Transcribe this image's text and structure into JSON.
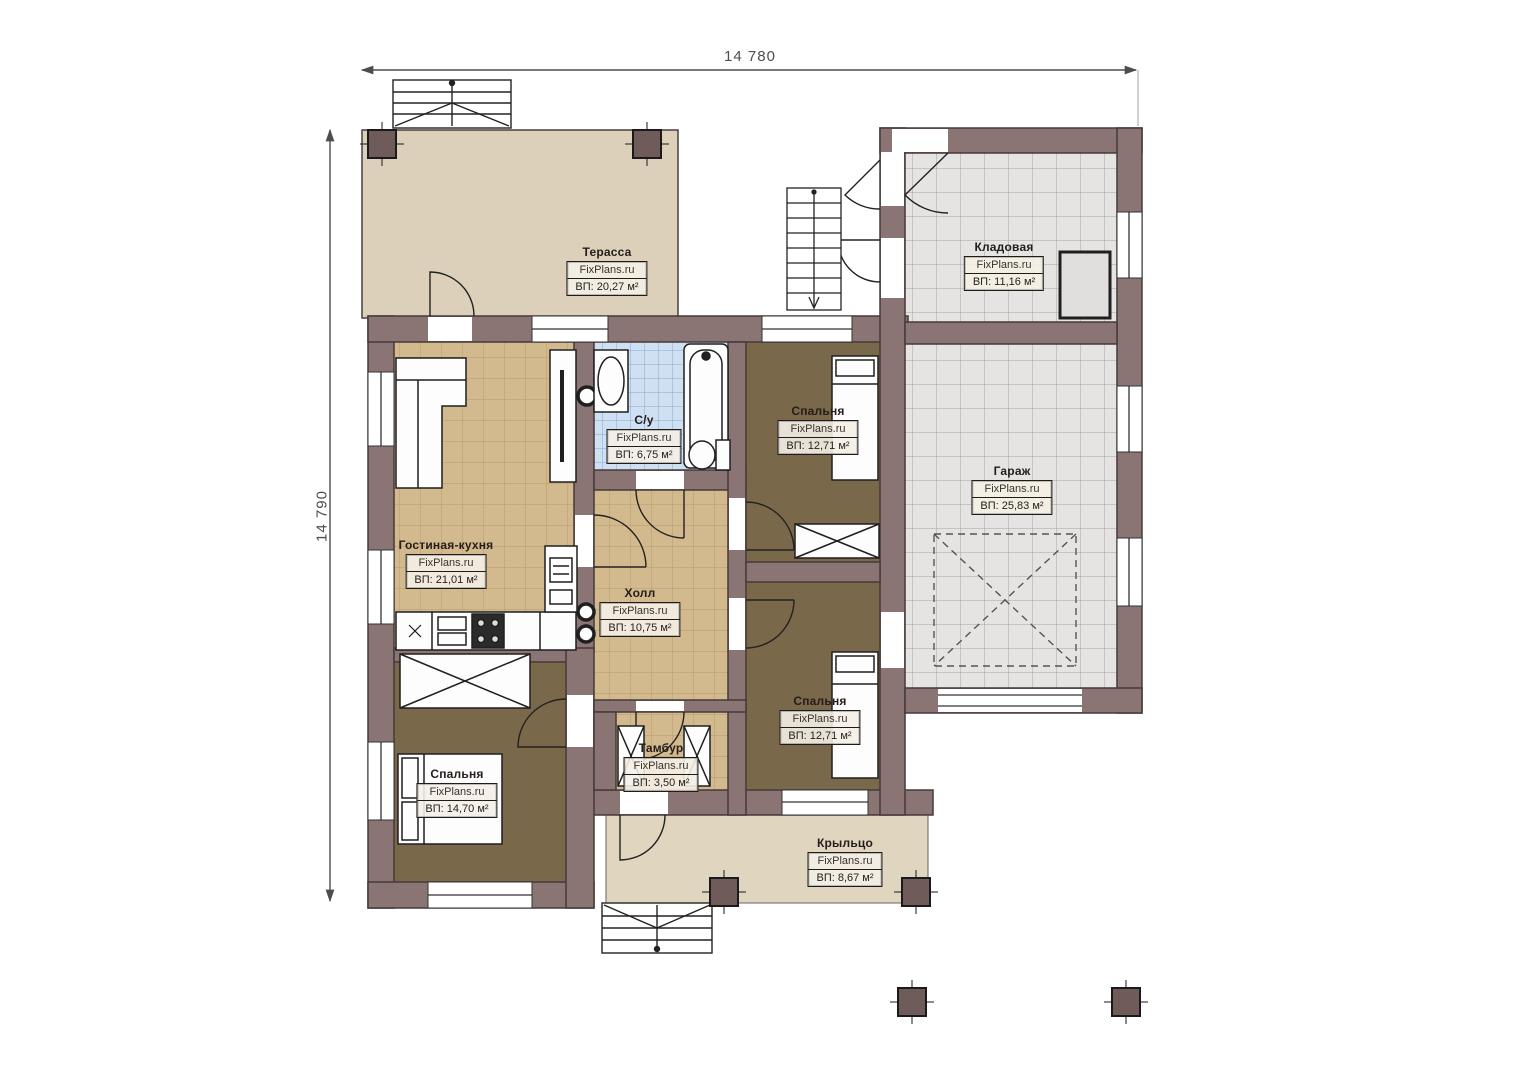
{
  "plan": {
    "dimensions": {
      "top": "14 780",
      "left": "14 790"
    },
    "branding": {
      "watermark": "FixPlans.ru"
    },
    "rooms": [
      {
        "id": "terrace",
        "name": "Терасса",
        "area": "ВП: 20,27 м²"
      },
      {
        "id": "storage",
        "name": "Кладовая",
        "area": "ВП: 11,16 м²"
      },
      {
        "id": "bedroom-top-right",
        "name": "Спальня",
        "area": "ВП: 12,71 м²"
      },
      {
        "id": "garage",
        "name": "Гараж",
        "area": "ВП: 25,83 м²"
      },
      {
        "id": "bathroom",
        "name": "С/у",
        "area": "ВП: 6,75 м²"
      },
      {
        "id": "living-kitchen",
        "name": "Гостиная-кухня",
        "area": "ВП: 21,01 м²"
      },
      {
        "id": "hall",
        "name": "Холл",
        "area": "ВП: 10,75 м²"
      },
      {
        "id": "bedroom-bottom-right",
        "name": "Спальня",
        "area": "ВП: 12,71 м²"
      },
      {
        "id": "tambour",
        "name": "Тамбур",
        "area": "ВП: 3,50 м²"
      },
      {
        "id": "bedroom-left",
        "name": "Спальня",
        "area": "ВП: 14,70 м²"
      },
      {
        "id": "porch",
        "name": "Крыльцо",
        "area": "ВП: 8,67 м²"
      }
    ],
    "colors": {
      "wall": "#8a7474",
      "floor_tan": "#d3b98e",
      "floor_blue": "#cfe0f3",
      "floor_gray": "#e5e4e2",
      "floor_brown": "#7a684a",
      "terrace": "#dcd0ba",
      "porch": "#e0d5bf"
    }
  }
}
